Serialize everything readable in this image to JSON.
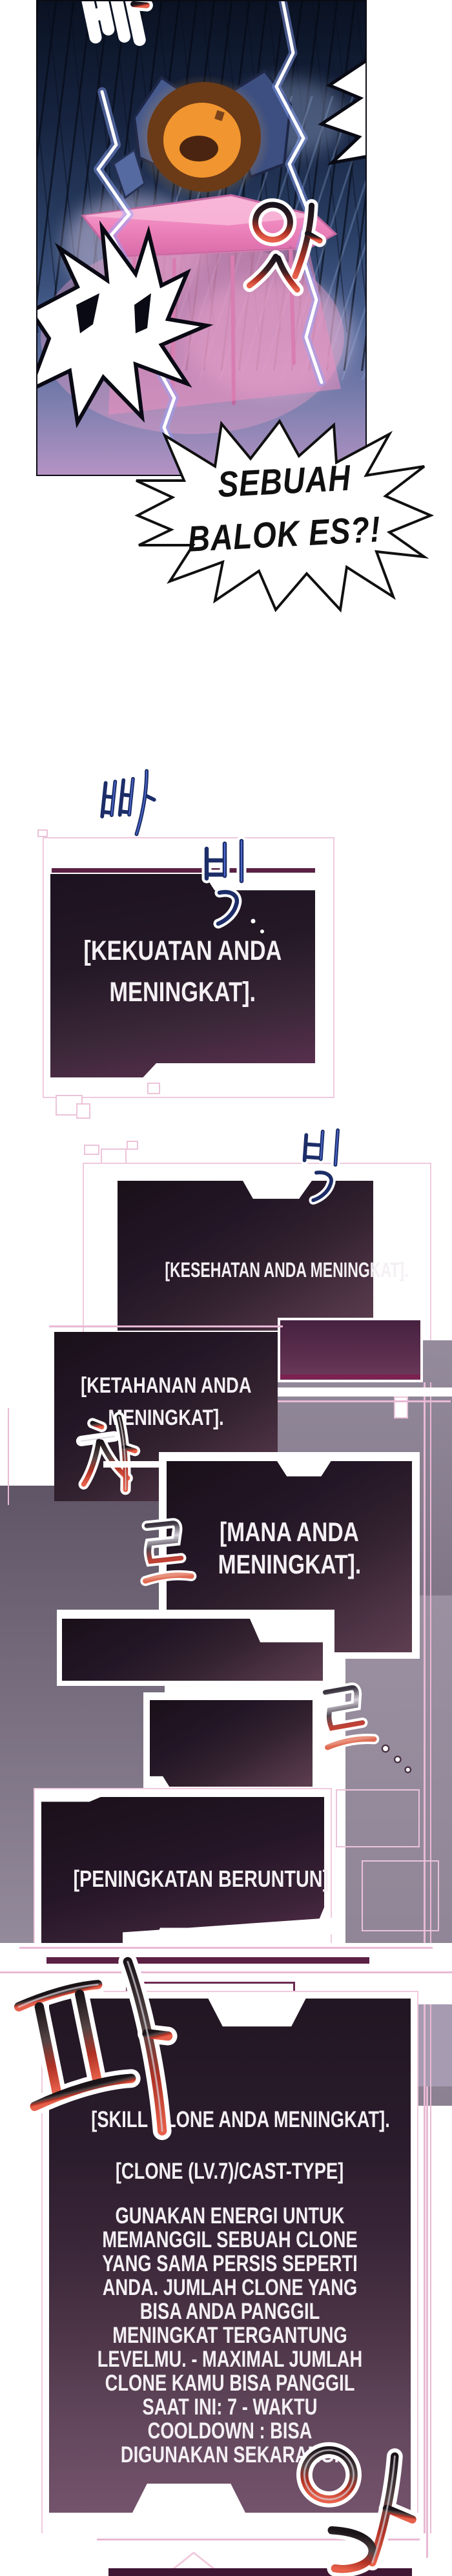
{
  "speech_bubble": {
    "line1": "SEBUAH",
    "line2": "BALOK ES?!"
  },
  "sfx": {
    "top_bba": "빠",
    "at": "앗",
    "bba_blue": "빠",
    "bik_1": "빅",
    "bik_2": "빅",
    "cha": "차",
    "reu_1": "르",
    "reu_2": "르",
    "pa": "파",
    "ak": "악"
  },
  "system_boxes": [
    {
      "id": "kekuatan",
      "lines": [
        "[KEKUATAN ANDA",
        "MENINGKAT]."
      ]
    },
    {
      "id": "kesehatan",
      "lines": [
        "[KESEHATAN ANDA MENINGKAT]."
      ]
    },
    {
      "id": "ketahanan",
      "lines": [
        "[KETAHANAN ANDA",
        "MENINGKAT]."
      ]
    },
    {
      "id": "mana",
      "lines": [
        "[MANA ANDA",
        "MENINGKAT]."
      ]
    },
    {
      "id": "peningkatan",
      "lines": [
        "[PENINGKATAN BERUNTUN]"
      ]
    },
    {
      "id": "skill-clone",
      "title": "[SKILL CLONE ANDA MENINGKAT].",
      "subtitle": "[CLONE (LV.7)/CAST-TYPE]",
      "body": "GUNAKAN ENERGI UNTUK MEMANGGIL SEBUAH CLONE YANG SAMA PERSIS SEPERTI ANDA. JUMLAH CLONE YANG BISA ANDA PANGGIL MENINGKAT TERGANTUNG LEVELMU. - MAXIMAL JUMLAH CLONE KAMU BISA PANGGIL SAAT INI: 7 - WAKTU COOLDOWN : BISA DIGUNAKAN SEKARANG."
    }
  ],
  "colors": {
    "page_bg": "#ffffff",
    "scene_navy": "#16233f",
    "panel_dark": "#241826",
    "panel_plum_bottom": "#7b5a72",
    "partial_box_plum": "#5c2e4e",
    "frame_pink": "#f0cade",
    "frame_maroon": "#5a2144",
    "backdrop_gray": "#8d8292",
    "system_text": "#f4f0f4",
    "bubble_text": "#101010",
    "sfx_blue": "#24367a",
    "sfx_red": "#c0392b",
    "table_pink": "#ef9ccb",
    "figure_orange": "#f0952f"
  }
}
